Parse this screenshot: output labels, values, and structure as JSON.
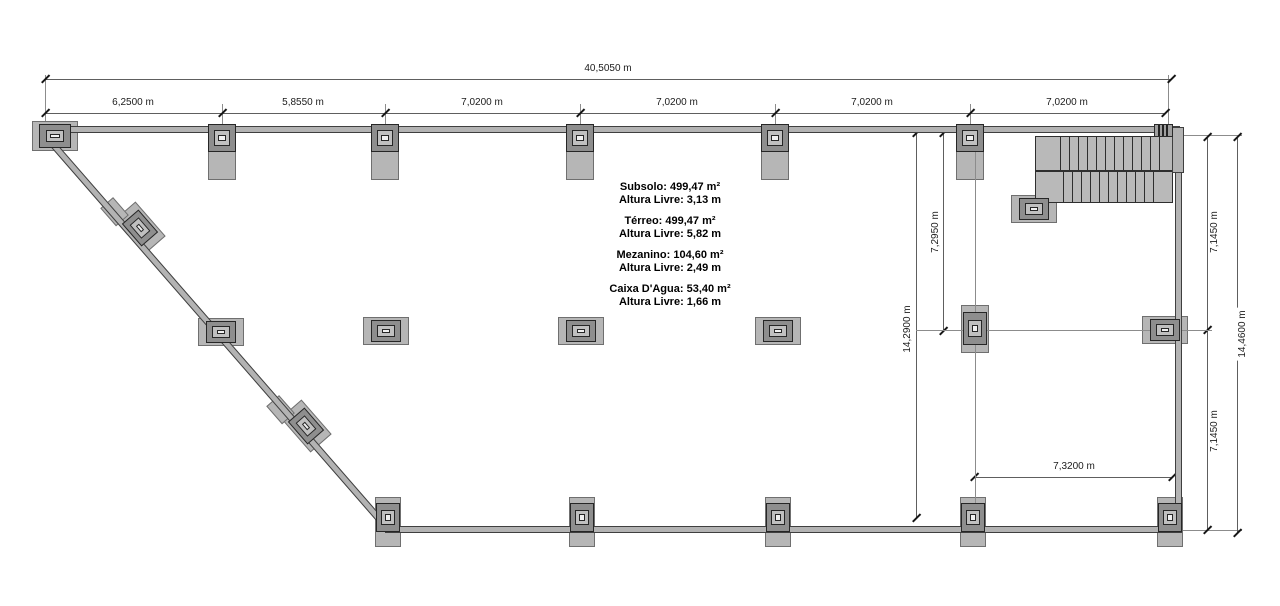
{
  "dimensions": {
    "top": {
      "overall": "40,5050 m",
      "segments": [
        "6,2500 m",
        "5,8550 m",
        "7,0200 m",
        "7,0200 m",
        "7,0200 m",
        "7,0200 m"
      ]
    },
    "right_inner": {
      "full_height": "14,2900 m",
      "upper": "7,2950 m"
    },
    "right_outer": {
      "upper": "7,1450 m",
      "lower": "7,1450 m",
      "full_height": "14,4600 m"
    },
    "bottom_bay": "7,3200 m"
  },
  "annotation": {
    "floors": [
      {
        "area": "Subsolo: 499,47 m²",
        "clearance": "Altura Livre: 3,13 m"
      },
      {
        "area": "Térreo: 499,47 m²",
        "clearance": "Altura Livre: 5,82 m"
      },
      {
        "area": "Mezanino: 104,60 m²",
        "clearance": "Altura Livre: 2,49 m"
      },
      {
        "area": "Caixa D'Agua: 53,40 m²",
        "clearance": "Altura Livre: 1,66 m"
      }
    ]
  },
  "colors": {
    "wall_fill": "#b3b3b3",
    "wall_outline": "#3f3f3f",
    "dimension_line": "#5e5e5e",
    "text": "#1c1c1c"
  }
}
